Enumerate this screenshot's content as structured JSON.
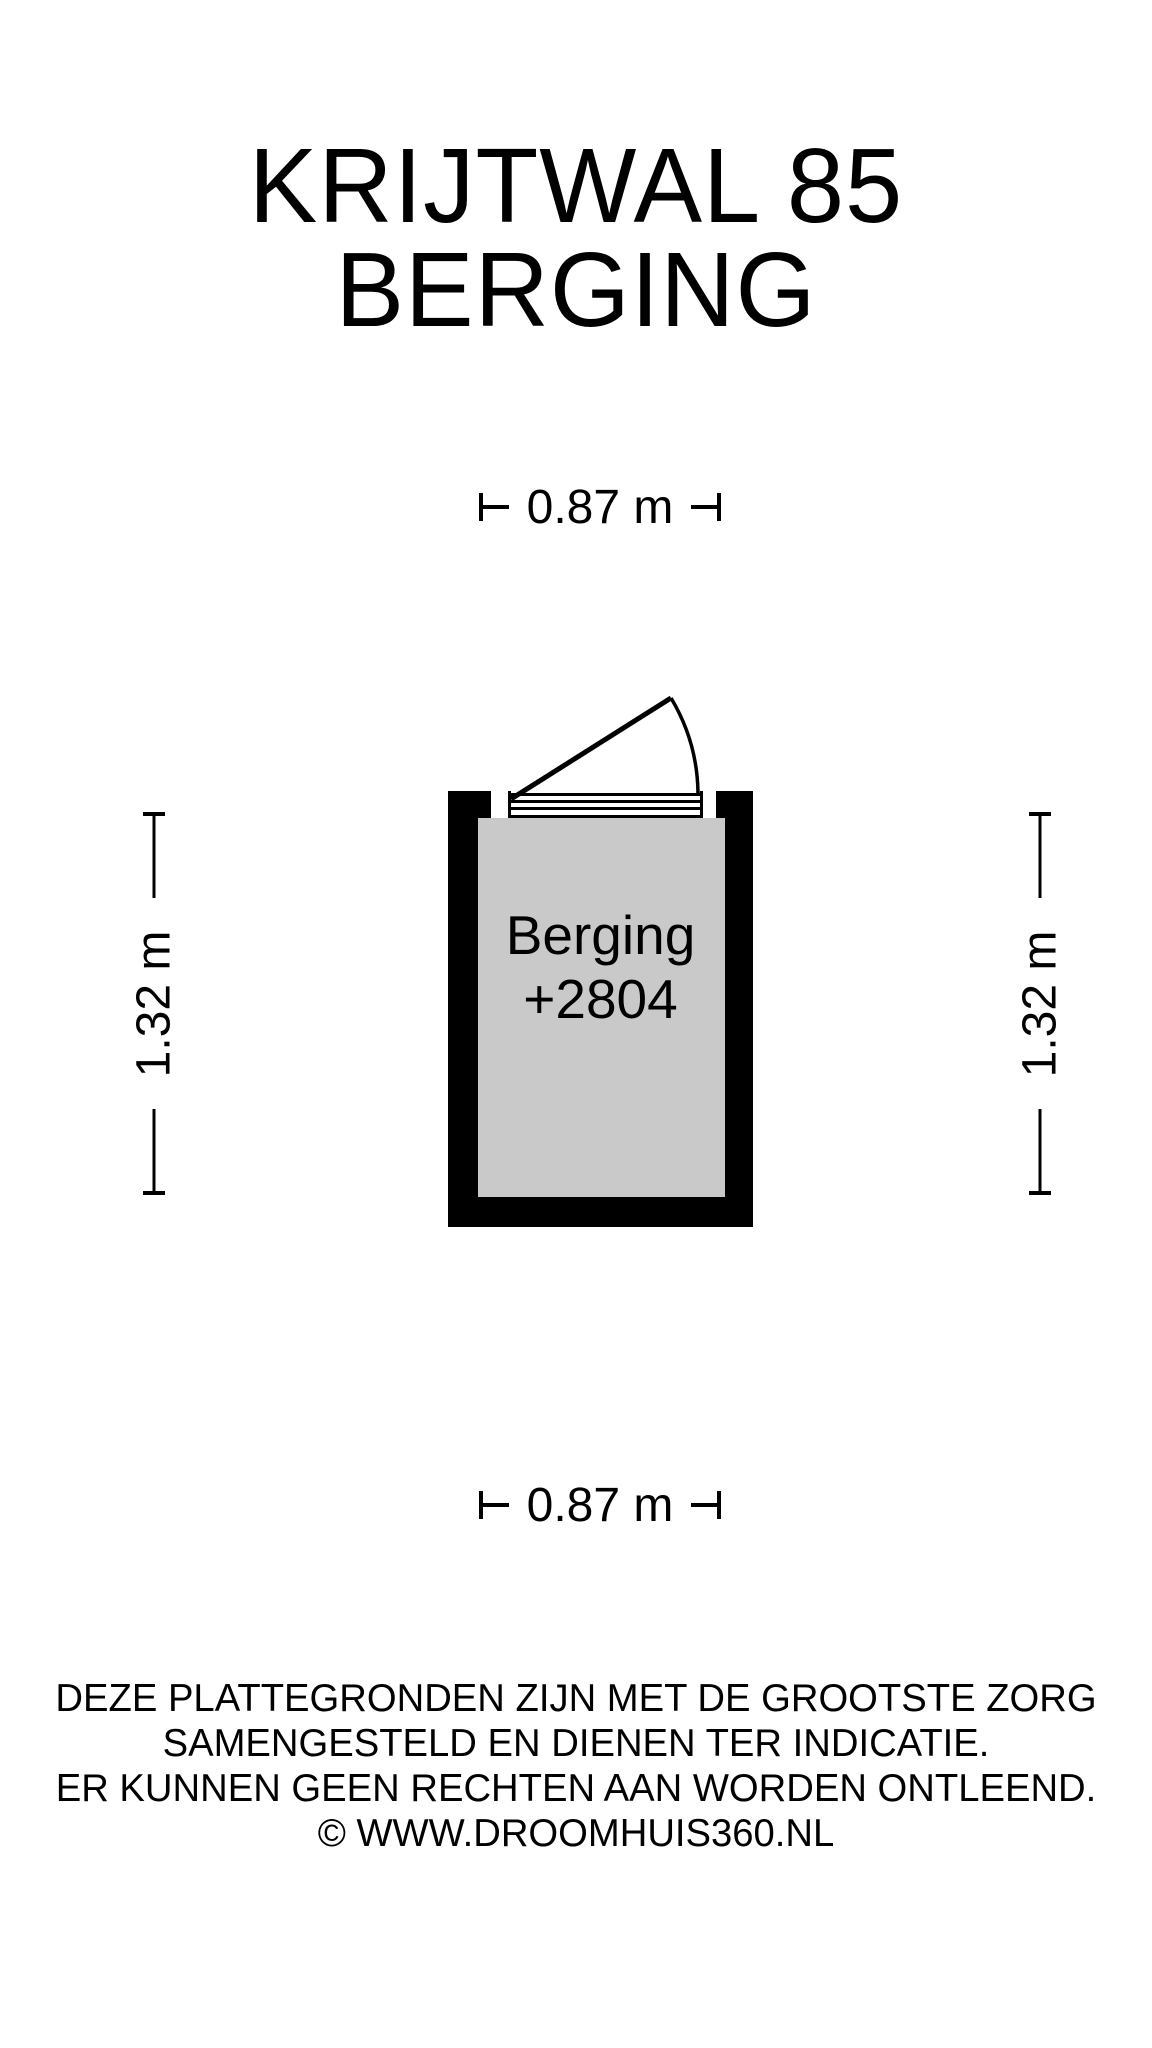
{
  "title": {
    "line1": "KRIJTWAL 85",
    "line2": "BERGING"
  },
  "dimensions": {
    "top": "0.87 m",
    "bottom": "0.87 m",
    "left": "1.32 m",
    "right": "1.32 m"
  },
  "room": {
    "name": "Berging",
    "level": "+2804"
  },
  "plan": {
    "wall_color": "#000000",
    "floor_color": "#c9c9c9",
    "line_color": "#000000"
  },
  "disclaimer": {
    "line1": "DEZE PLATTEGRONDEN ZIJN MET DE GROOTSTE ZORG",
    "line2": "SAMENGESTELD EN DIENEN TER INDICATIE.",
    "line3": "ER KUNNEN GEEN RECHTEN AAN WORDEN ONTLEEND.",
    "line4": "© WWW.DROOMHUIS360.NL"
  }
}
